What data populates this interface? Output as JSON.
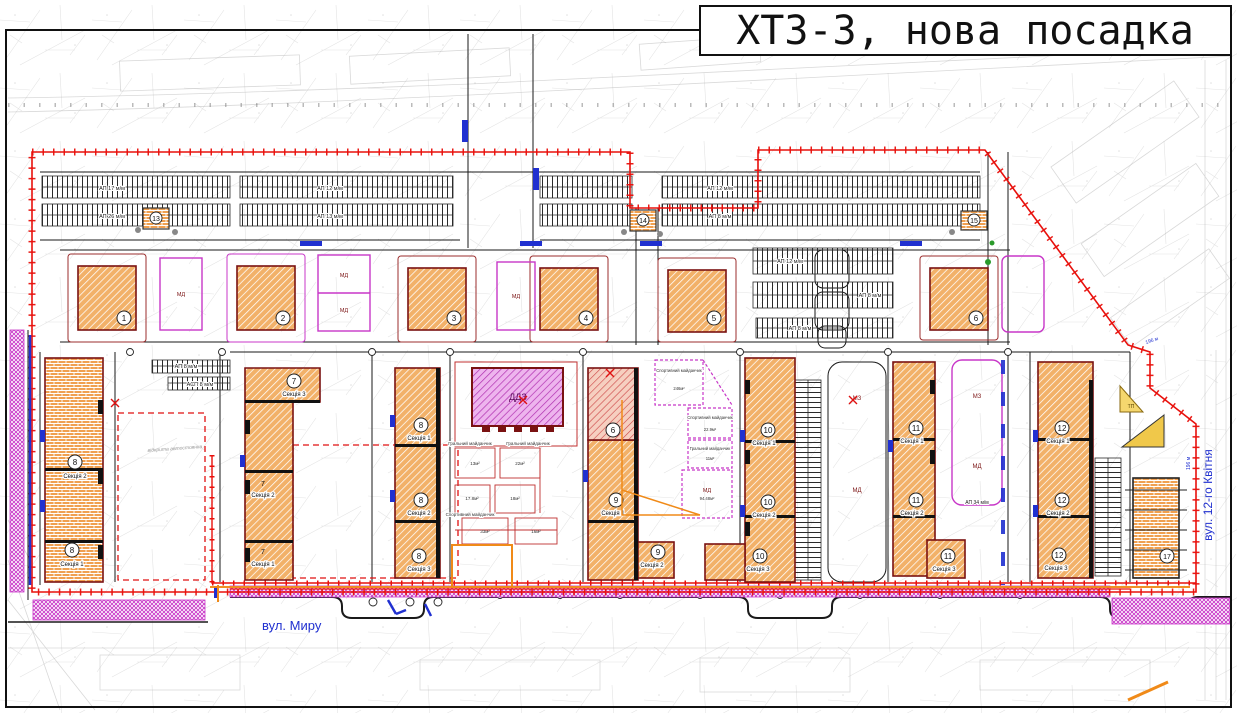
{
  "title": "ХТЗ-3, нова посадка",
  "streets": {
    "bottom": "вул. Миру",
    "right": "вул. 12-го Квітня"
  },
  "buildings": {
    "sq": [
      "1",
      "2",
      "3",
      "4",
      "5",
      "6"
    ],
    "small": {
      "b13": "13",
      "b14": "14",
      "b15": "15",
      "b17": "17"
    },
    "left8": {
      "num": "8",
      "s_top": "Секція 2",
      "s_bot": "Секція 1"
    },
    "b7": {
      "num": "7",
      "s1": "Секція 1",
      "s2": "Секція 2",
      "s3": "Секція 3"
    },
    "b8": {
      "num": "8",
      "s1": "Секція 1",
      "s2": "Секція 2",
      "s3": "Секція 3"
    },
    "b9": {
      "num": "9",
      "old_num": "6",
      "s1": "Секція 1",
      "s2": "Секція 2"
    },
    "b10": {
      "num": "10",
      "s1": "Секція 1",
      "s2": "Секція 2",
      "s3": "Секція 3"
    },
    "b11": {
      "num": "11",
      "s1": "Секція 1",
      "s2": "Секція 2",
      "s3": "Секція 3"
    },
    "b12": {
      "num": "12",
      "s1": "Секція 1",
      "s2": "Секція 2",
      "s3": "Секція 3"
    },
    "ddz": "ДДЗ",
    "tp": "ТП"
  },
  "parking": {
    "p1": "АП 17 м/м",
    "p2": "АП 26 м/м",
    "p3": "АП 12 м/м",
    "p4": "АП 13 м/м",
    "p7": "АП 12 м/м",
    "p8": "АП 8 м/м",
    "p9": "АП 12 м/м",
    "p10": "АП 8 м/м",
    "p11": "АП 8 м/м",
    "p12": "АП 34 м/м",
    "p13": "АП 8 м/м",
    "p14": "АСП 8 м/м",
    "open": "відкрита автостоянка"
  },
  "zones": {
    "mz_a": "МЗ",
    "md_a": "МД",
    "mz_b": "МЗ",
    "md_b": "МД",
    "md_row1": "МД",
    "md_row2": "МД",
    "md_row3": "МД",
    "md_row4": "МД",
    "md_c": "МД",
    "md_c_area": "94.48м²"
  },
  "playgrounds": {
    "sport1": "Спортивний майданчик",
    "sport1_area": "246м²",
    "sport2": "Спортивний майданчик",
    "sport2_area": "22.9м²",
    "play1": "Гральний майданчик",
    "play1_area": "11м²",
    "court_caption1": "Гральний майданчик",
    "court_caption2": "Гральний майданчик",
    "court_caption3": "Спортивний майданчик",
    "a1": "13м²",
    "a2": "22м²",
    "a3": "17.8м²",
    "a4": "18м²",
    "a5": "33м²",
    "a6": "16м²"
  },
  "dims": {
    "d1": "196 м",
    "d2": "196 м"
  },
  "colors": {
    "boundary": "#e8100c",
    "building_fill": "#f2b169",
    "building_stroke": "#7a1212",
    "magenta": "#c837c8",
    "blue": "#2030d0",
    "orange_util": "#f08a18",
    "yellow": "#f0c84a"
  }
}
